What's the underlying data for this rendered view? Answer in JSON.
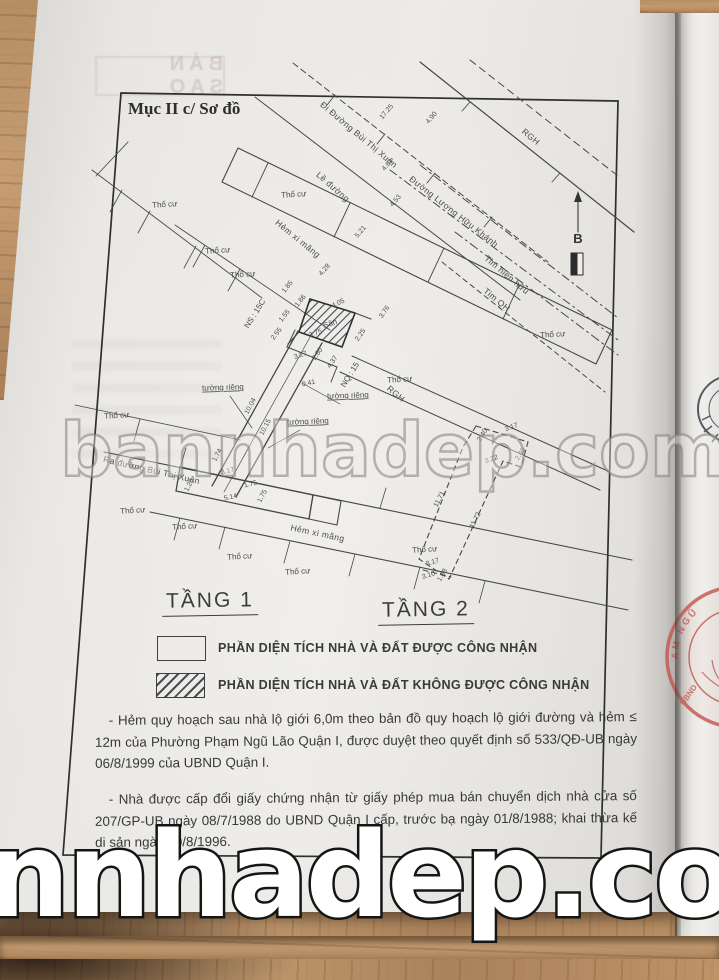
{
  "header": {
    "section_title": "Mục II c/ Sơ đồ",
    "copy_stamp": "BẢN SAO"
  },
  "floors": {
    "floor1": "TẦNG 1",
    "floor2": "TẦNG 2"
  },
  "legend": {
    "recognized": "PHẦN DIỆN TÍCH NHÀ VÀ ĐẤT ĐƯỢC CÔNG NHẬN",
    "not_recognized": "PHẦN DIỆN TÍCH NHÀ VÀ ĐẤT KHÔNG ĐƯỢC CÔNG NHẬN"
  },
  "notes": {
    "note1": "- Hẻm quy hoạch sau nhà lộ giới 6,0m theo bản đồ quy hoạch lộ giới đường và hẻm ≤ 12m của Phường Phạm Ngũ Lão Quận I, được duyệt theo quyết định số 533/QĐ-UB ngày 06/8/1999 của UBND Quận I.",
    "note2": "- Nhà được cấp đổi giấy chứng nhận từ giấy phép mua bán chuyển dịch nhà cửa số 207/GP-UB ngày 08/7/1988 do UBND Quận I cấp, trước bạ ngày 01/8/1988; khai thừa kế di sản ngày 10/8/1996."
  },
  "watermarks": {
    "center": "bannhadep.com",
    "bottom": "nnhadep.com"
  },
  "stamps": {
    "red_arc": "AM NGŨ",
    "red_side": "UBND"
  },
  "colors": {
    "stamp_red": "#c2554f",
    "wood": "#b38b62",
    "paper": "#e9e7e3",
    "ink": "#47474b"
  },
  "diagram": {
    "labels": [
      {
        "t": "Đi Đường Bùi Thị Xuân",
        "x": 357,
        "y": 137,
        "r": 40,
        "cls": "street"
      },
      {
        "t": "Đường Lương Hữu Khánh",
        "x": 452,
        "y": 214,
        "r": 38,
        "cls": "street"
      },
      {
        "t": "Lề đường",
        "x": 331,
        "y": 189,
        "r": 41,
        "cls": "street"
      },
      {
        "t": "Hẻm xi măng",
        "x": 296,
        "y": 241,
        "r": 39,
        "cls": "street"
      },
      {
        "t": "Hẻm xi măng",
        "x": 317,
        "y": 536,
        "r": 12,
        "cls": "street"
      },
      {
        "t": "Ra đường Bùi Thị Xuân",
        "x": 151,
        "y": 473,
        "r": 13,
        "cls": "street"
      },
      {
        "t": "Tim hiện hữu",
        "x": 505,
        "y": 277,
        "r": 40,
        "cls": "street"
      },
      {
        "t": "Tim QH",
        "x": 495,
        "y": 302,
        "r": 40,
        "cls": "street"
      },
      {
        "t": "RGH",
        "x": 529,
        "y": 139,
        "r": 40,
        "cls": "street"
      },
      {
        "t": "RGH",
        "x": 394,
        "y": 396,
        "r": 40,
        "cls": "street"
      },
      {
        "t": "B",
        "x": 578,
        "y": 243,
        "r": 0,
        "cls": "north"
      },
      {
        "t": "Thổ cư",
        "x": 165,
        "y": 207,
        "r": -4,
        "cls": "area"
      },
      {
        "t": "Thổ cư",
        "x": 294,
        "y": 197,
        "r": -4,
        "cls": "area"
      },
      {
        "t": "Thổ cư",
        "x": 218,
        "y": 253,
        "r": -4,
        "cls": "area"
      },
      {
        "t": "Thổ cư",
        "x": 243,
        "y": 277,
        "r": -4,
        "cls": "area"
      },
      {
        "t": "Thổ cư",
        "x": 553,
        "y": 337,
        "r": -4,
        "cls": "area"
      },
      {
        "t": "Thổ cư",
        "x": 400,
        "y": 382,
        "r": -4,
        "cls": "area"
      },
      {
        "t": "Thổ cư",
        "x": 117,
        "y": 418,
        "r": -4,
        "cls": "area"
      },
      {
        "t": "Thổ cư",
        "x": 133,
        "y": 513,
        "r": -4,
        "cls": "area"
      },
      {
        "t": "Thổ cư",
        "x": 185,
        "y": 529,
        "r": -4,
        "cls": "area"
      },
      {
        "t": "Thổ cư",
        "x": 240,
        "y": 559,
        "r": -4,
        "cls": "area"
      },
      {
        "t": "Thổ cư",
        "x": 298,
        "y": 574,
        "r": -4,
        "cls": "area"
      },
      {
        "t": "Thổ cư",
        "x": 425,
        "y": 552,
        "r": -4,
        "cls": "area"
      },
      {
        "t": "tường riêng",
        "x": 223,
        "y": 390,
        "r": -2,
        "cls": "callout"
      },
      {
        "t": "tường riêng",
        "x": 348,
        "y": 398,
        "r": -2,
        "cls": "callout"
      },
      {
        "t": "tường riêng",
        "x": 308,
        "y": 424,
        "r": -2,
        "cls": "callout"
      },
      {
        "t": "NS : 15C",
        "x": 257,
        "y": 315,
        "r": -58,
        "cls": "name"
      },
      {
        "t": "NQ : 15",
        "x": 352,
        "y": 376,
        "r": -58,
        "cls": "name"
      },
      {
        "t": "Sân",
        "x": 331,
        "y": 326,
        "r": -20,
        "cls": "name"
      },
      {
        "t": "17.25",
        "x": 388,
        "y": 113,
        "r": -50,
        "cls": "dim"
      },
      {
        "t": "4.90",
        "x": 433,
        "y": 119,
        "r": -50,
        "cls": "dim"
      },
      {
        "t": "4.61",
        "x": 389,
        "y": 166,
        "r": -50,
        "cls": "dim"
      },
      {
        "t": "4.53",
        "x": 397,
        "y": 202,
        "r": -50,
        "cls": "dim"
      },
      {
        "t": "5.21",
        "x": 362,
        "y": 233,
        "r": -50,
        "cls": "dim"
      },
      {
        "t": "4.28",
        "x": 326,
        "y": 271,
        "r": -50,
        "cls": "dim"
      },
      {
        "t": "1.85",
        "x": 289,
        "y": 288,
        "r": -52,
        "cls": "dim"
      },
      {
        "t": "1.86",
        "x": 302,
        "y": 302,
        "r": -52,
        "cls": "dim"
      },
      {
        "t": "4.05",
        "x": 339,
        "y": 305,
        "r": -26,
        "cls": "dim"
      },
      {
        "t": "1.55",
        "x": 286,
        "y": 317,
        "r": -52,
        "cls": "dim"
      },
      {
        "t": "2.55",
        "x": 278,
        "y": 335,
        "r": -52,
        "cls": "dim"
      },
      {
        "t": "3.75",
        "x": 316,
        "y": 335,
        "r": -20,
        "cls": "dim"
      },
      {
        "t": "2.25",
        "x": 362,
        "y": 336,
        "r": -55,
        "cls": "dim"
      },
      {
        "t": "3.76",
        "x": 386,
        "y": 313,
        "r": -55,
        "cls": "dim"
      },
      {
        "t": "3.27",
        "x": 301,
        "y": 357,
        "r": -18,
        "cls": "dim"
      },
      {
        "t": "2.60",
        "x": 319,
        "y": 355,
        "r": -55,
        "cls": "dim"
      },
      {
        "t": "4.37",
        "x": 334,
        "y": 363,
        "r": -55,
        "cls": "dim"
      },
      {
        "t": "0.41",
        "x": 309,
        "y": 385,
        "r": -12,
        "cls": "dim"
      },
      {
        "t": "10.04",
        "x": 252,
        "y": 407,
        "r": -62,
        "cls": "dim"
      },
      {
        "t": "10.15",
        "x": 267,
        "y": 428,
        "r": -62,
        "cls": "dim"
      },
      {
        "t": "1.74",
        "x": 219,
        "y": 456,
        "r": -62,
        "cls": "dim"
      },
      {
        "t": "1.20",
        "x": 191,
        "y": 486,
        "r": -62,
        "cls": "dim"
      },
      {
        "t": "3.17",
        "x": 228,
        "y": 473,
        "r": -14,
        "cls": "dim"
      },
      {
        "t": "1.75",
        "x": 251,
        "y": 486,
        "r": -13,
        "cls": "dim"
      },
      {
        "t": "1.75",
        "x": 264,
        "y": 497,
        "r": -62,
        "cls": "dim"
      },
      {
        "t": "5.14",
        "x": 231,
        "y": 499,
        "r": -13,
        "cls": "dim"
      },
      {
        "t": "3.17",
        "x": 512,
        "y": 429,
        "r": -20,
        "cls": "dim"
      },
      {
        "t": "2.40",
        "x": 484,
        "y": 436,
        "r": -58,
        "cls": "dim"
      },
      {
        "t": "3.22",
        "x": 492,
        "y": 461,
        "r": -20,
        "cls": "dim"
      },
      {
        "t": "2.40",
        "x": 522,
        "y": 455,
        "r": -58,
        "cls": "dim"
      },
      {
        "t": "11.71",
        "x": 441,
        "y": 500,
        "r": -63,
        "cls": "dim"
      },
      {
        "t": "11.72",
        "x": 477,
        "y": 521,
        "r": -63,
        "cls": "dim"
      },
      {
        "t": "3.17",
        "x": 433,
        "y": 564,
        "r": -17,
        "cls": "dim"
      },
      {
        "t": "3.10",
        "x": 429,
        "y": 577,
        "r": -17,
        "cls": "dim"
      },
      {
        "t": "1.08",
        "x": 444,
        "y": 576,
        "r": -60,
        "cls": "dim"
      }
    ]
  }
}
